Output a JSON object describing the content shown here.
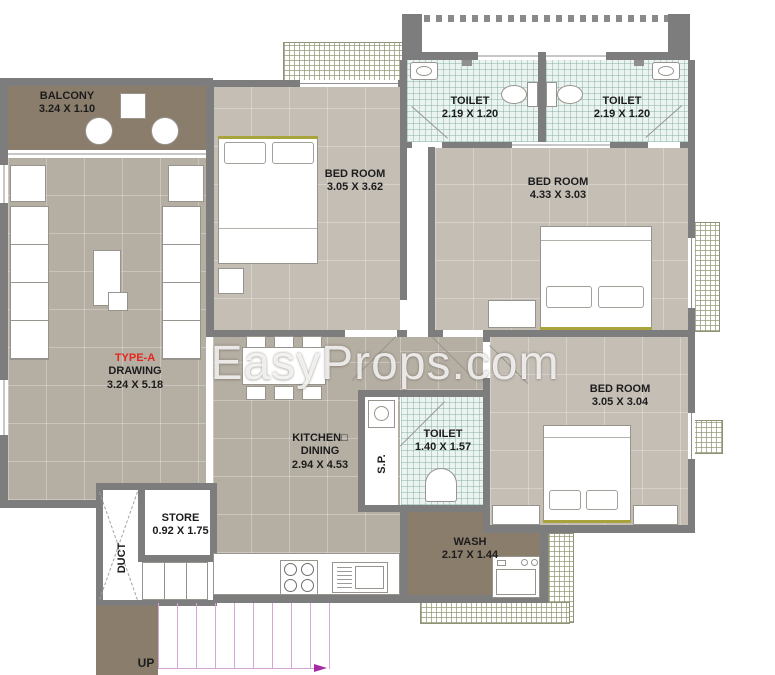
{
  "watermark": "EasyProps.com",
  "unit": {
    "type_label": "TYPE-A",
    "rooms": {
      "balcony": {
        "name": "BALCONY",
        "dims": "3.24 X 1.10"
      },
      "drawing": {
        "name": "DRAWING",
        "dims": "3.24 X 5.18"
      },
      "bedroom_1": {
        "name": "BED ROOM",
        "dims": "3.05 X 3.62"
      },
      "bedroom_2": {
        "name": "BED ROOM",
        "dims": "4.33 X 3.03"
      },
      "bedroom_3": {
        "name": "BED ROOM",
        "dims": "3.05 X 3.04"
      },
      "toilet_1": {
        "name": "TOILET",
        "dims": "2.19 X 1.20"
      },
      "toilet_2": {
        "name": "TOILET",
        "dims": "2.19 X 1.20"
      },
      "toilet_3": {
        "name": "TOILET",
        "dims": "1.40 X 1.57"
      },
      "kitchen": {
        "name": "KITCHEN□",
        "name2": "DINING",
        "dims": "2.94 X 4.53"
      },
      "store": {
        "name": "STORE",
        "dims": "0.92 X 1.75"
      },
      "wash": {
        "name": "WASH",
        "dims": "2.17 X 1.44"
      },
      "duct": {
        "name": "DUCT"
      },
      "soil_pipe_shaft": {
        "name": "S.P."
      }
    },
    "stairs": {
      "label": "UP"
    }
  },
  "colors": {
    "wall": "#7d7d7d",
    "floor_living": "#b5aea3",
    "floor_bedroom": "#c4beb5",
    "floor_balcony": "#8a7d6c",
    "toilet_tile": "#ebf4f0",
    "accent_red": "#e8241c",
    "stair_line": "#d5a6d6",
    "stair_arrow": "#a62ba0",
    "headboard_olive": "#a8a43b"
  }
}
